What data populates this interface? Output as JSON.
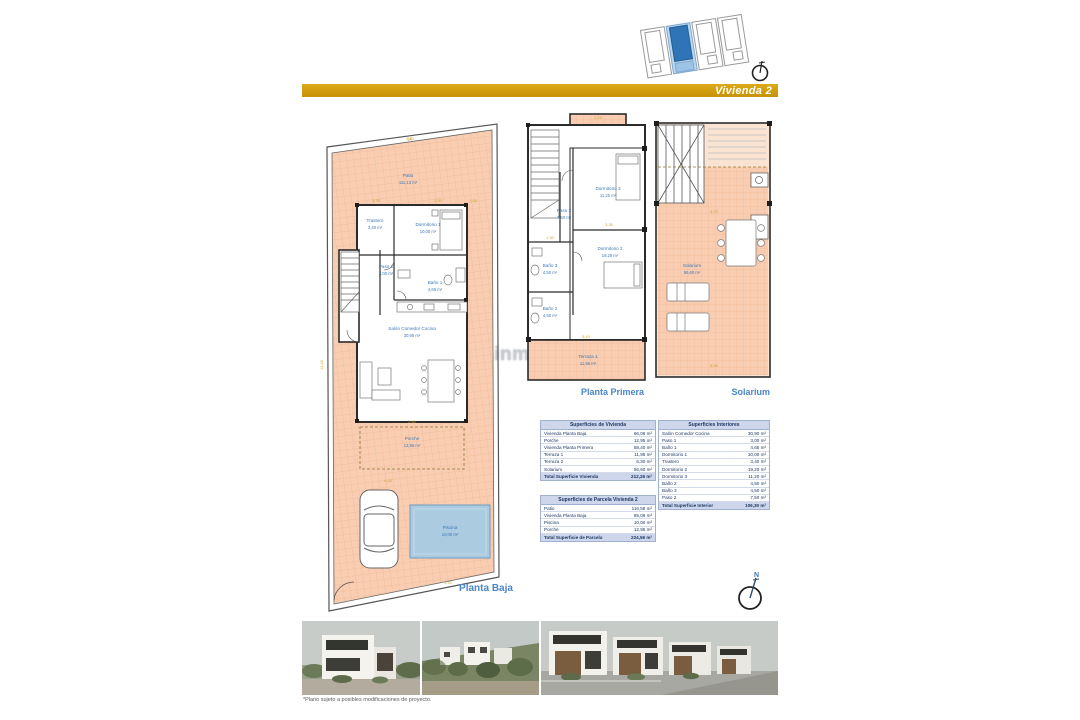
{
  "banner": {
    "label": "Vivienda 2",
    "color": "#D7A512"
  },
  "watermark": {
    "text": "www.inmo-tore.com"
  },
  "site_locator": {
    "units": 4,
    "highlighted_unit": 2
  },
  "compass": {
    "north_label": "N"
  },
  "plans": {
    "planta_baja": {
      "label": "Planta Baja",
      "rooms": {
        "patio": {
          "name": "Patio",
          "area": "111,13 m²"
        },
        "trastero": {
          "name": "Trastero",
          "area": "3,40 m²"
        },
        "dormitorio1": {
          "name": "Dormitorio 1",
          "area": "10,00 m²"
        },
        "paso1": {
          "name": "Paso 1",
          "area": "3,00 m²"
        },
        "bano1": {
          "name": "Baño 1",
          "area": "4,65 m²"
        },
        "salon": {
          "name": "Salón Comedor Cocina",
          "area": "30,90 m²"
        },
        "porche": {
          "name": "Porche",
          "area": "12,95 m²"
        },
        "piscina": {
          "name": "Piscina",
          "area": "10,00 m²"
        }
      },
      "dims": [
        "5,10",
        "3,35",
        "2,30",
        "12,40",
        "4,20",
        "2,60",
        "3,20",
        "1,05"
      ]
    },
    "planta_primera": {
      "label": "Planta Primera",
      "rooms": {
        "terraza2": {
          "name": "Terraza 2",
          "area": "6,30 m²"
        },
        "dormitorio3": {
          "name": "Dormitorio 3",
          "area": "11,20 m²"
        },
        "paso2": {
          "name": "Paso 2",
          "area": "7,50 m²"
        },
        "bano3": {
          "name": "Baño 3",
          "area": "4,50 m²"
        },
        "dormitorio2": {
          "name": "Dormitorio 2",
          "area": "19,20 m²"
        },
        "bano2": {
          "name": "Baño 2",
          "area": "4,50 m²"
        },
        "terraza1": {
          "name": "Terraza 1",
          "area": "11,95 m²"
        }
      },
      "dims": [
        "2,10",
        "3,35",
        "5,10",
        "1,90"
      ]
    },
    "solarium": {
      "label": "Solarium",
      "rooms": {
        "solarium": {
          "name": "Solarium",
          "area": "56,60 m²"
        }
      },
      "dims": [
        "4,70",
        "5,95"
      ]
    }
  },
  "tables": {
    "vivienda": {
      "title": "Superficies de Vivienda",
      "rows": [
        {
          "label": "Vivienda Planta Baja",
          "value": "66,06 m²"
        },
        {
          "label": "Porche",
          "value": "12,95 m²"
        },
        {
          "label": "Vivienda Planta Primera",
          "value": "58,40 m²"
        },
        {
          "label": "Terraza 1",
          "value": "11,95 m²"
        },
        {
          "label": "Terraza 2",
          "value": "6,30 m²"
        },
        {
          "label": "Solarium",
          "value": "56,60 m²"
        }
      ],
      "total": {
        "label": "Total Superficie Vivienda",
        "value": "212,26 m²"
      }
    },
    "parcela": {
      "title": "Superficies de Parcela Vivienda 2",
      "rows": [
        {
          "label": "Patio",
          "value": "116,58 m²"
        },
        {
          "label": "Vivienda Planta Baja",
          "value": "85,06 m²"
        },
        {
          "label": "Piscina",
          "value": "10,00 m²"
        },
        {
          "label": "Porche",
          "value": "12,95 m²"
        }
      ],
      "total": {
        "label": "Total Superficie de Parcela",
        "value": "224,59 m²"
      }
    },
    "interiores": {
      "title": "Superficies Interiores",
      "rows": [
        {
          "label": "Salón Comedor Cocina",
          "value": "30,90 m²"
        },
        {
          "label": "Paso 1",
          "value": "3,00 m²"
        },
        {
          "label": "Baño 1",
          "value": "4,65 m²"
        },
        {
          "label": "Dormitorio 1",
          "value": "10,00 m²"
        },
        {
          "label": "Trastero",
          "value": "3,40 m²"
        },
        {
          "label": "Dormitorio 2",
          "value": "19,20 m²"
        },
        {
          "label": "Dormitorio 3",
          "value": "11,20 m²"
        },
        {
          "label": "Baño 2",
          "value": "4,50 m²"
        },
        {
          "label": "Baño 3",
          "value": "4,50 m²"
        },
        {
          "label": "Paso 2",
          "value": "7,50 m²"
        }
      ],
      "total": {
        "label": "Total Superficie Interior",
        "value": "106,30 m²"
      }
    }
  },
  "footer": {
    "note": "*Plano sujeto a posibles modificaciones de proyecto."
  }
}
